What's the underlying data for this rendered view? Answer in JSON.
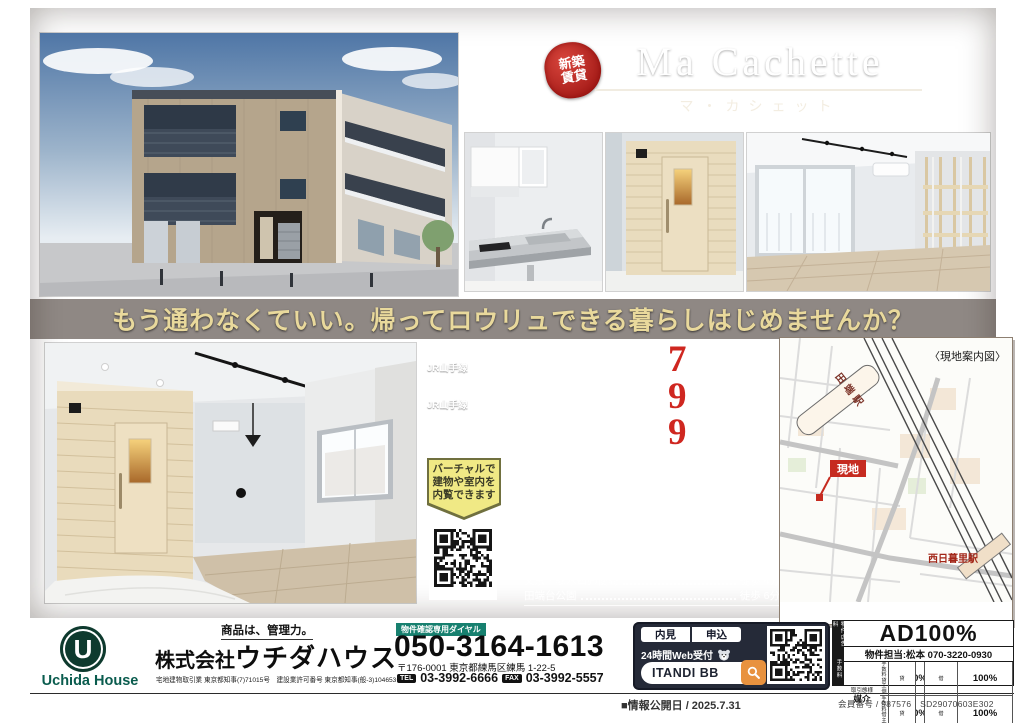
{
  "colors": {
    "accent_red": "#c62b20",
    "catch_gold": "#e9d99c",
    "teal": "#17806f",
    "logo_green": "#0a5c4e",
    "orange": "#e8923f",
    "itandi_dark": "#252a38",
    "wood": "#877565"
  },
  "header": {
    "badge_top": "新築",
    "badge_bottom": "賃貸",
    "title": "Ma Cachette",
    "subtitle": "マ・カシェット"
  },
  "catchcopy": "もう通わなくていい。帰ってロウリュできる暮らしはじめませんか？",
  "access": [
    {
      "line": "JR山手線",
      "station": "「田　　端」",
      "walk": "駅徒歩",
      "min": "7",
      "unit": "分",
      "dist": "(500m)"
    },
    {
      "line": "JR山手線",
      "station": "「西日暮里」",
      "walk": "駅徒歩",
      "min": "9",
      "unit": "分",
      "dist": "(700m)"
    },
    {
      "line": "東京メトロ",
      "line2": "千代田線",
      "station": "「西日暮里」",
      "walk": "駅徒歩",
      "min": "9",
      "unit": "分",
      "dist": "(700m)"
    }
  ],
  "virtual_badge": {
    "line1": "バーチャルで",
    "line2": "建物や室内を",
    "line3": "内覧できます"
  },
  "lifeinfo": {
    "title": "Lifeinformation",
    "subtitle": "周辺施設",
    "items": [
      {
        "name": "コープ 田端店",
        "walk": "徒歩 3分"
      },
      {
        "name": "まいばすけっと 田端動坂店",
        "walk": "徒歩 4分"
      },
      {
        "name": "ユニバーサルドラッグ 動坂店",
        "walk": "徒歩 5分"
      },
      {
        "name": "ファミリーマート 田端一丁目店",
        "walk": "徒歩 3分"
      },
      {
        "name": "ローソン 田端与楽寺前店",
        "walk": "徒歩 3分"
      },
      {
        "name": "キャンドゥ 西日暮里駅前店",
        "walk": "徒歩10分"
      },
      {
        "name": "文京千駄木四郵便局",
        "walk": "徒歩 4分"
      },
      {
        "name": "田端台公園",
        "walk": "徒歩 6分"
      }
    ]
  },
  "map": {
    "caption": "〈現地案内図〉",
    "tabata": "田端駅",
    "nishinippori": "西日暮里駅",
    "site": "現地"
  },
  "footer": {
    "logo_letter": "U",
    "logo_text": "Uchida House",
    "tagline": "商品は、管理力。",
    "company_prefix": "株式会社",
    "company_name": "ウチダハウス",
    "license": "宅地建物取引業 東京都知事(7)71015号　建設業許可番号 東京都知事(般-3)104653号",
    "dial_label": "物件確認専用ダイヤル",
    "dial": "050-3164-1613",
    "address": "〒176-0001 東京都練馬区練馬 1-22-5",
    "tel_label": "TEL",
    "tel": "03-3992-6666",
    "fax_label": "FAX",
    "fax": "03-3992-5557",
    "itandi": {
      "naiken": "内見",
      "apply": "申込",
      "web": "24時間Web受付",
      "brand": "ITANDI BB"
    },
    "ad": {
      "strip_top": "物件広告料",
      "strip_bottom": "手数料",
      "headline": "AD100%",
      "contact": "物件担当:松本 070-3220-0930",
      "rows": [
        {
          "label": "手数料 貸主側",
          "k1": "貸",
          "v1": "0%",
          "k2": "借",
          "v2": "100%"
        },
        {
          "label": "手数料 借主側",
          "k1": "貸",
          "v1": "0%",
          "k2": "借",
          "v2": "100%"
        }
      ],
      "deal_label": "取引態様",
      "deal": "媒介"
    },
    "published": "■情報公開日 / 2025.7.31",
    "member": "会員番号 / 987576　SD29070603E302"
  }
}
